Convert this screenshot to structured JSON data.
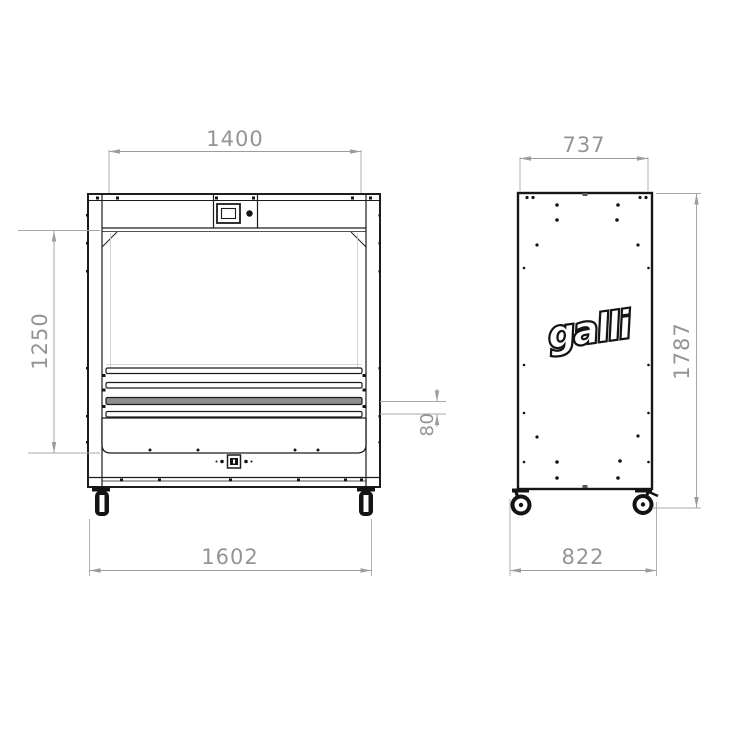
{
  "front_view": {
    "name": "front elevation",
    "dimensions": {
      "inner_width": "1400",
      "opening_height": "1250",
      "bar_gap": "80",
      "overall_width": "1602"
    }
  },
  "side_view": {
    "name": "side elevation",
    "logo_text": "galli",
    "dimensions": {
      "depth": "737",
      "overall_height": "1787",
      "overall_depth": "822"
    }
  },
  "colors": {
    "line": "#1c1c1c",
    "dimension": "#9c9c9c",
    "background": "#ffffff"
  }
}
